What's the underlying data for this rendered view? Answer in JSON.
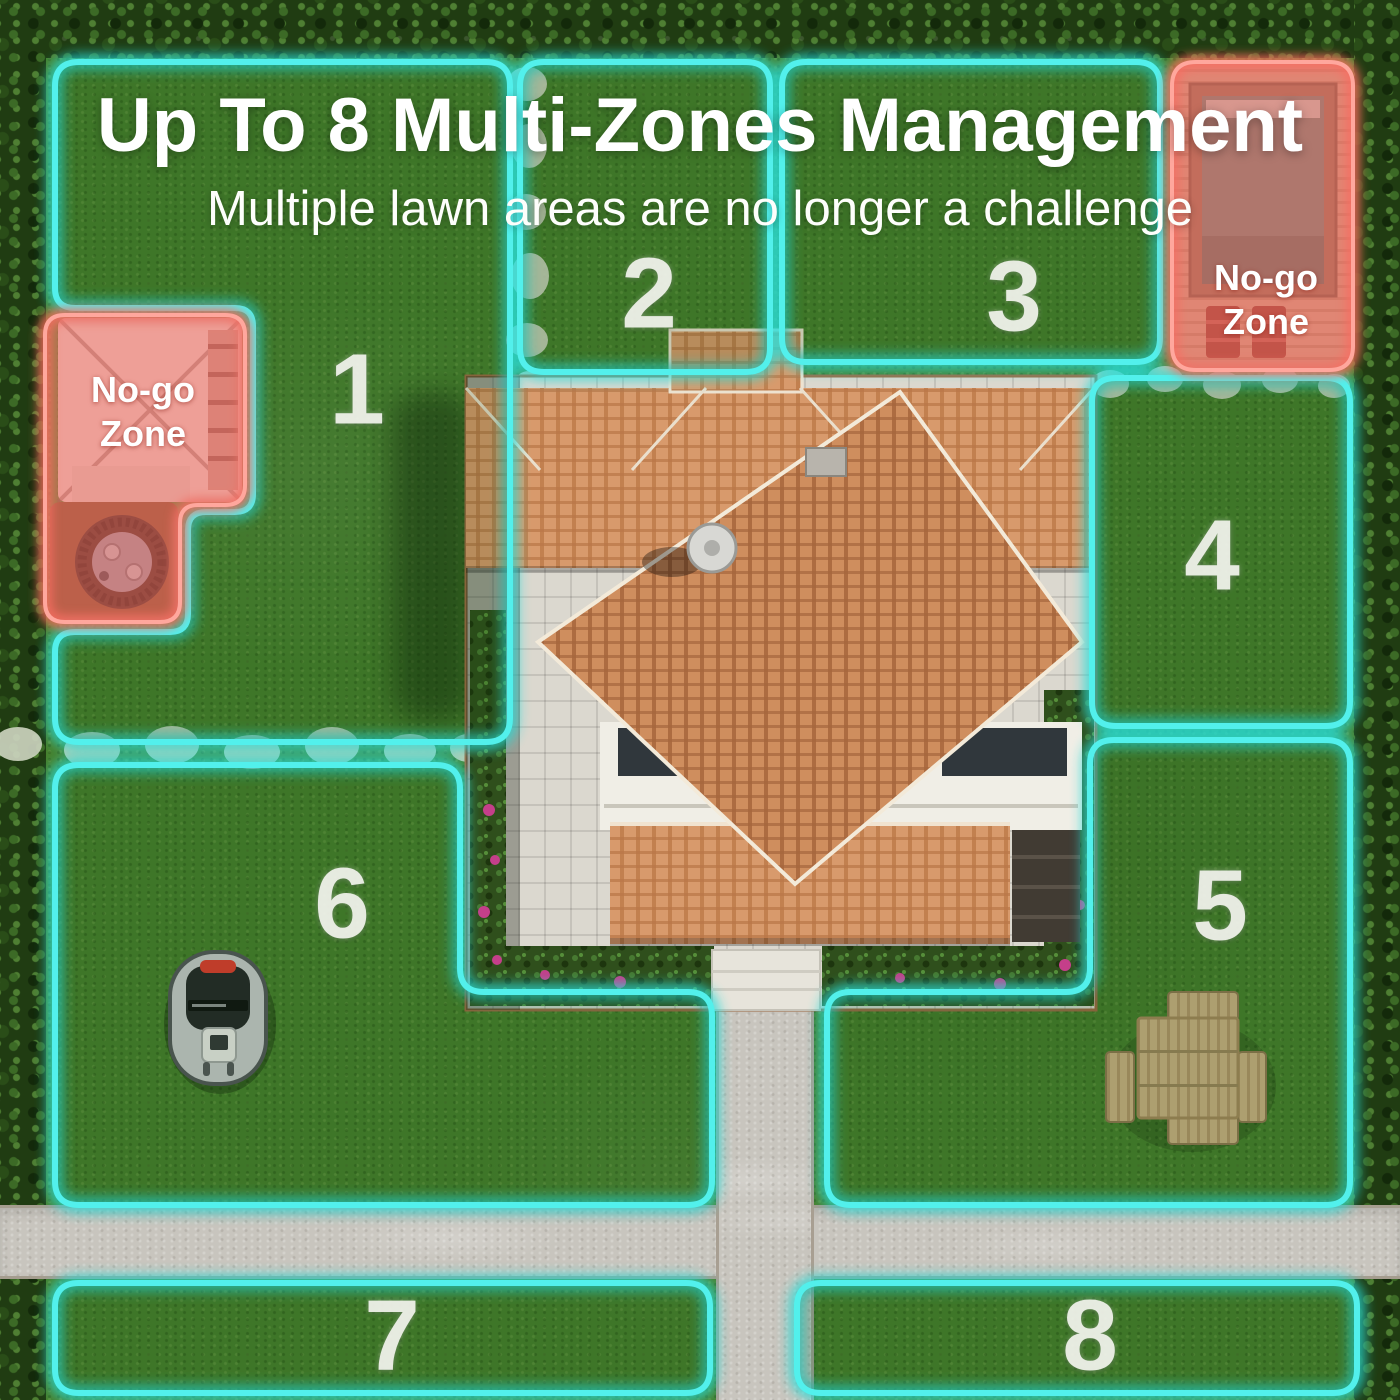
{
  "header": {
    "title": "Up To 8 Multi-Zones Management",
    "subtitle": "Multiple lawn areas are no longer a challenge"
  },
  "zones": [
    {
      "label": "1"
    },
    {
      "label": "2"
    },
    {
      "label": "3"
    },
    {
      "label": "4"
    },
    {
      "label": "5"
    },
    {
      "label": "6"
    },
    {
      "label": "7"
    },
    {
      "label": "8"
    }
  ],
  "no_go_zones": [
    {
      "id": "tent",
      "line1": "No-go",
      "line2": "Zone"
    },
    {
      "id": "pool",
      "line1": "No-go",
      "line2": "Zone"
    }
  ],
  "objects": {
    "mower": "robotic-lawn-mower",
    "house": "villa-with-terracotta-roof",
    "picnic_table": "wooden-picnic-table",
    "fire_pit": "fire-pit",
    "tent": "canopy-tent",
    "pool": "swimming-pool",
    "paths": "concrete-paths-and-stepping-stones"
  },
  "colors": {
    "zone_outline": "#3FE9E4",
    "no_go_overlay": "#F2756B",
    "grass": "#47802E",
    "road": "#C8C5BE",
    "roof": "#D79A6C",
    "text": "#FFFFFF"
  }
}
